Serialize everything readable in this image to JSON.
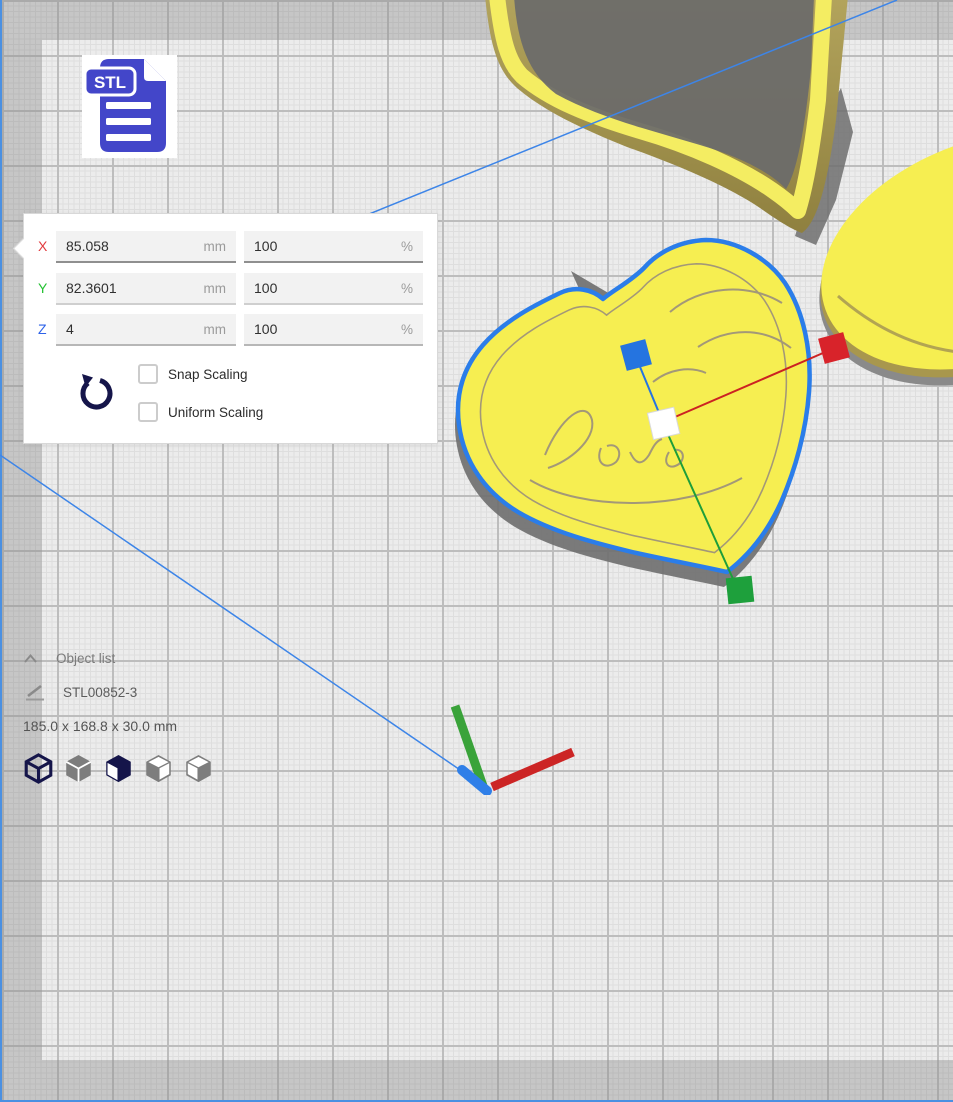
{
  "file_badge": {
    "label": "STL"
  },
  "scale_panel": {
    "rows": [
      {
        "axis": "X",
        "axis_color": "#e23b3e",
        "value": "85.058",
        "unit": "mm",
        "percent": "100",
        "percent_unit": "%"
      },
      {
        "axis": "Y",
        "axis_color": "#25c234",
        "value": "82.3601",
        "unit": "mm",
        "percent": "100",
        "percent_unit": "%"
      },
      {
        "axis": "Z",
        "axis_color": "#2e62e8",
        "value": "4",
        "unit": "mm",
        "percent": "100",
        "percent_unit": "%"
      }
    ],
    "checkboxes": [
      {
        "label": "Snap Scaling",
        "checked": false
      },
      {
        "label": "Uniform Scaling",
        "checked": false
      }
    ],
    "reset_icon": "rotate-ccw",
    "reset_color": "#15154a"
  },
  "object_list": {
    "header": "Object list",
    "item_name": "STL00852-3",
    "dimensions": "185.0 x 168.8 x 30.0 mm",
    "view_icons": [
      "view-3d",
      "view-front-solid",
      "view-front",
      "view-left",
      "view-right"
    ],
    "active_icon_color": "#15154a",
    "inactive_icon_color": "#7d7d7d"
  },
  "viewport": {
    "model_color": "#f6ee51",
    "wall_shade_color": "#a8974d",
    "rim_highlight_color": "#f4ed62",
    "selection_color": "#2b7de9",
    "shadow_color": "#6e6e6e",
    "plate_edge_color": "#4a90e2",
    "handles": {
      "x_color": "#d8232a",
      "y_color": "#1ea03c",
      "z_color": "#2574e0",
      "center_color": "#ffffff"
    }
  }
}
